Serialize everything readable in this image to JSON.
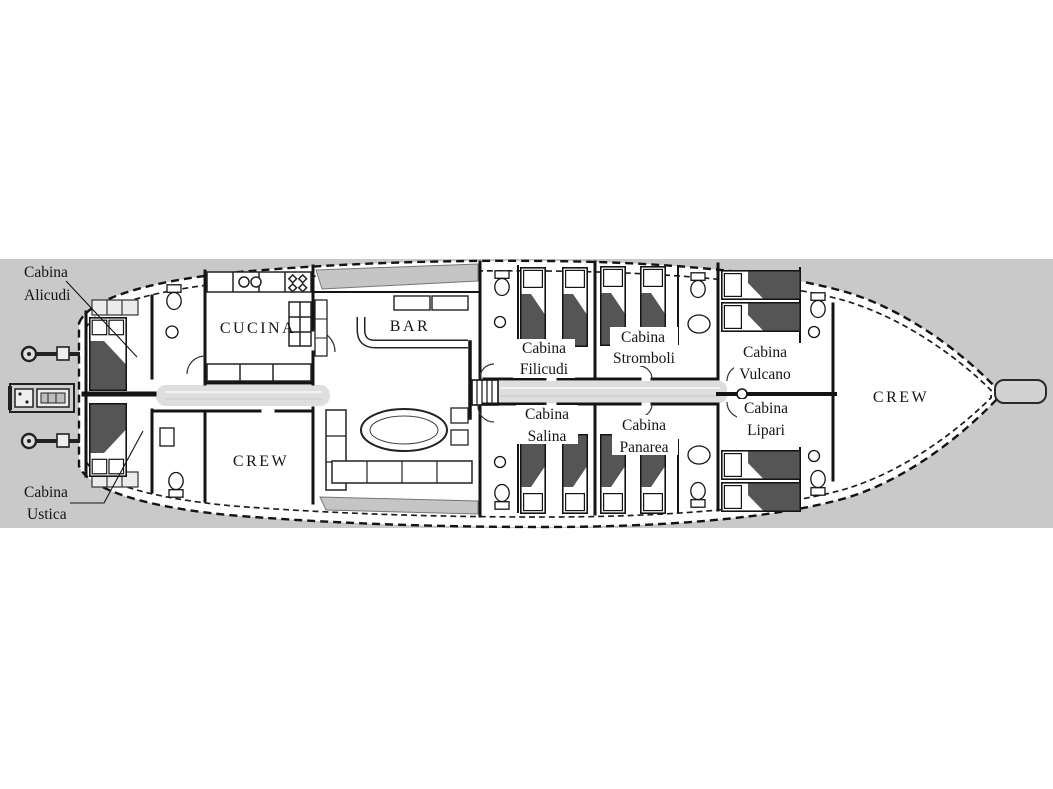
{
  "figure": {
    "kind": "yacht deck plan",
    "background_color": "#ffffff",
    "band_color": "#c9c9c9",
    "hull_fill": "#ffffff",
    "line_color": "#141414",
    "bed_blanket_color": "#555555",
    "corridor_color": "#dedede",
    "deck_pad_color": "#c5c5c5"
  },
  "rooms": [
    {
      "id": "cabina-alicudi",
      "lines": [
        "Cabina",
        "Alicudi"
      ]
    },
    {
      "id": "cabina-ustica",
      "lines": [
        "Cabina",
        "Ustica"
      ]
    },
    {
      "id": "cucina",
      "lines": [
        "CUCINA"
      ]
    },
    {
      "id": "bar",
      "lines": [
        "BAR"
      ]
    },
    {
      "id": "crew-aft",
      "lines": [
        "CREW"
      ]
    },
    {
      "id": "cabina-filicudi",
      "lines": [
        "Cabina",
        "Filicudi"
      ]
    },
    {
      "id": "cabina-salina",
      "lines": [
        "Cabina",
        "Salina"
      ]
    },
    {
      "id": "cabina-stromboli",
      "lines": [
        "Cabina",
        "Stromboli"
      ]
    },
    {
      "id": "cabina-panarea",
      "lines": [
        "Cabina",
        "Panarea"
      ]
    },
    {
      "id": "cabina-vulcano",
      "lines": [
        "Cabina",
        "Vulcano"
      ]
    },
    {
      "id": "cabina-lipari",
      "lines": [
        "Cabina",
        "Lipari"
      ]
    },
    {
      "id": "crew-bow",
      "lines": [
        "CREW"
      ]
    }
  ]
}
